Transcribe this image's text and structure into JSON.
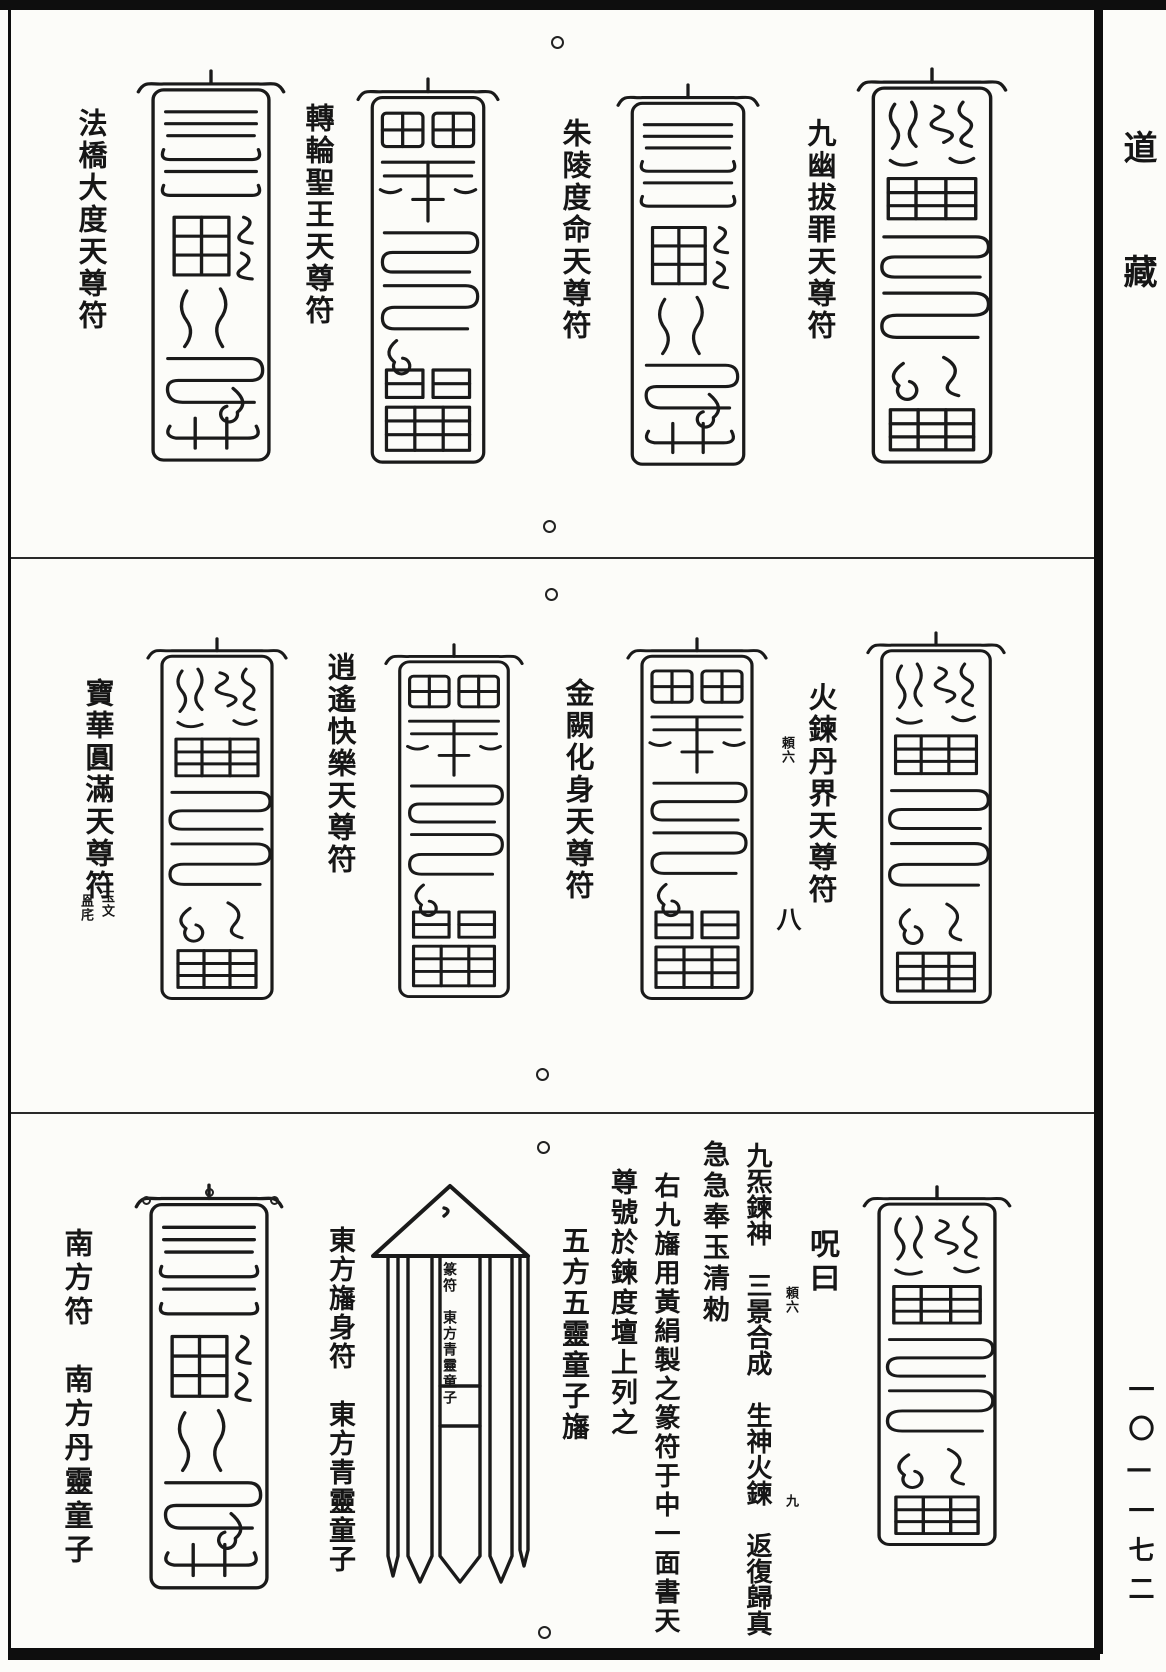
{
  "margin": {
    "collection_title": "道藏",
    "page_number": "一〇—一七二"
  },
  "sections": [
    {
      "talismans": [
        {
          "label": "法橋大度天尊符"
        },
        {
          "label": "轉輪聖王天尊符"
        },
        {
          "label": "朱陵度命天尊符"
        },
        {
          "label": "九幽拔罪天尊符"
        }
      ]
    },
    {
      "talismans": [
        {
          "label": "寶華圓滿天尊符",
          "note_right": "玉文",
          "note_left": "𥁕㡯"
        },
        {
          "label": "逍遙快樂天尊符"
        },
        {
          "label": "金闕化身天尊符"
        },
        {
          "label": "火鍊丹界天尊符",
          "note": "頼六",
          "column_marker": "八"
        }
      ]
    },
    {
      "south_talisman_label": "南方符　南方丹靈童子",
      "banner_label": "東方旛身符　東方青靈童子",
      "banner_inscription": "篆符　東方青靈童子",
      "incantation": {
        "heading": "呪曰",
        "col1": "九炁鍊神　三景合成　生神火鍊　返復歸真",
        "col1_note1": "頼六",
        "col1_note2": "九",
        "col2": "急急奉玉清勑",
        "col3": "右九旛用黃絹製之篆符于中一面書天",
        "col4": "尊號於鍊度壇上列之",
        "col5": "五方五靈童子旛"
      }
    }
  ]
}
